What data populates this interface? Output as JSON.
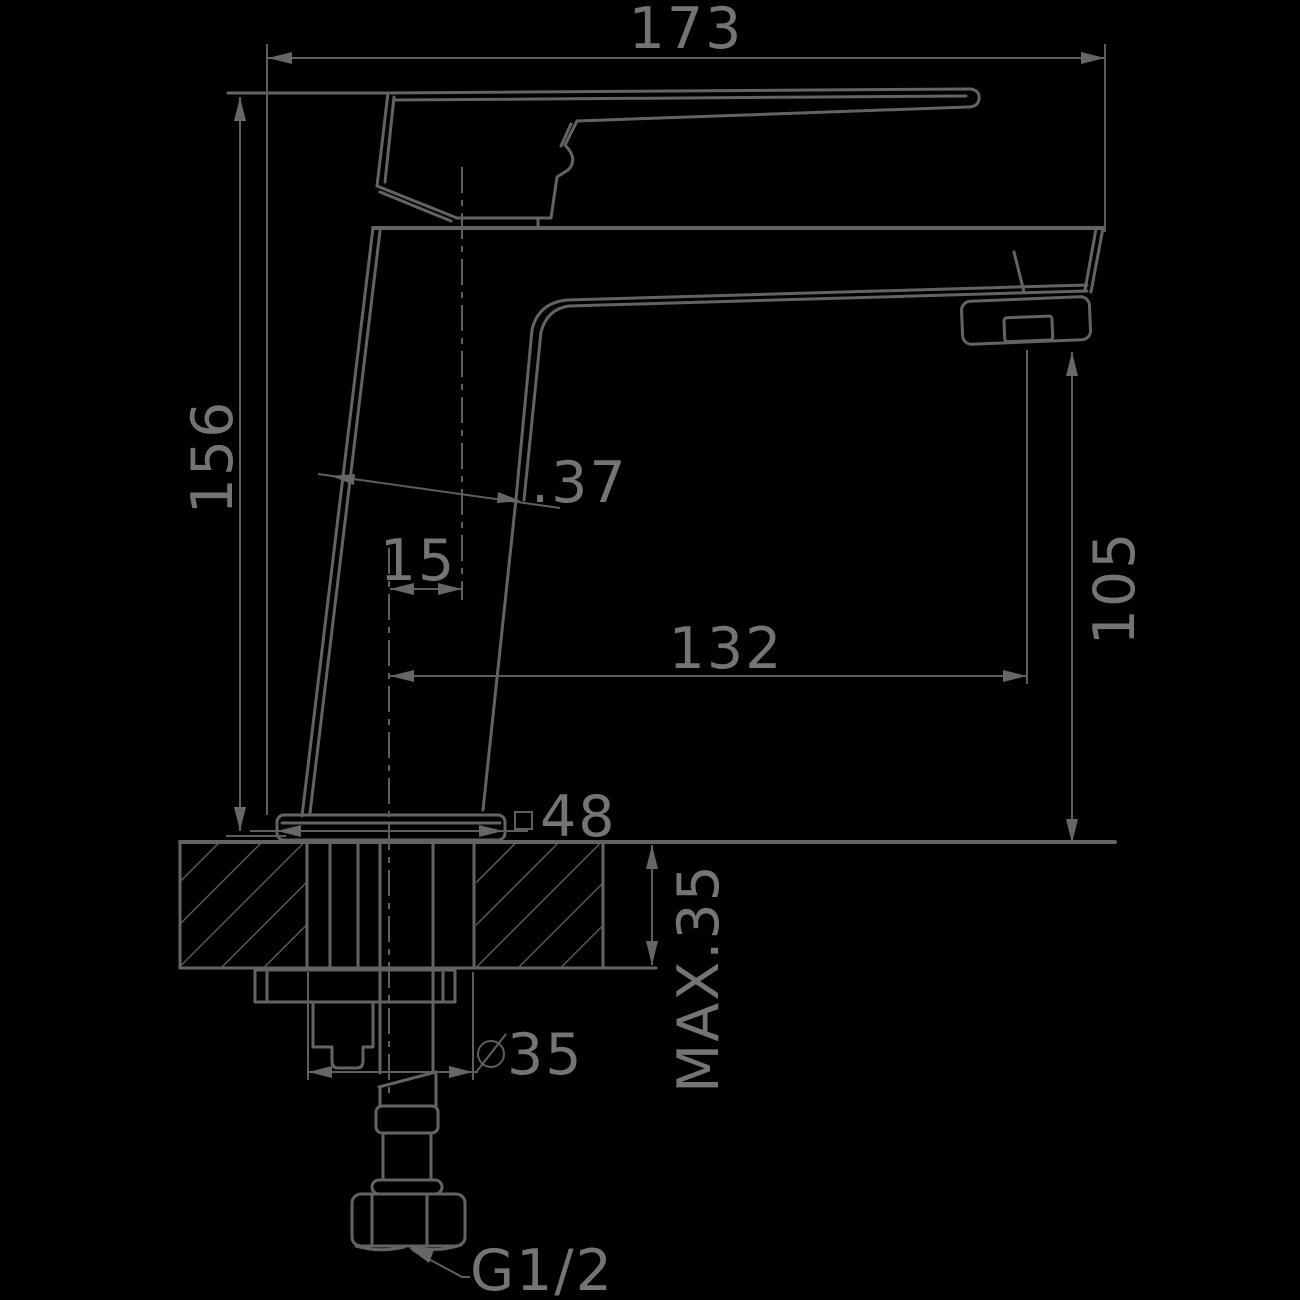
{
  "drawing": {
    "type": "technical-dimension-drawing",
    "subject": "single-lever basin mixer faucet, side elevation with mounting section",
    "colors": {
      "background": "#000000",
      "line": "#636363",
      "text": "#747474"
    },
    "dimensions": {
      "overall_length": "173",
      "overall_height": "156",
      "body_depth": ".37",
      "handle_axis_offset": "15",
      "spout_reach": "132",
      "spout_outlet_height": "105",
      "base_square": "48",
      "counter_max_thickness": "MAX.35",
      "mounting_hole_diameter": "35",
      "connection_thread": "G1/2"
    },
    "symbols": {
      "square_section": "square-symbol before 48",
      "diameter": "diameter-symbol before 35"
    }
  }
}
